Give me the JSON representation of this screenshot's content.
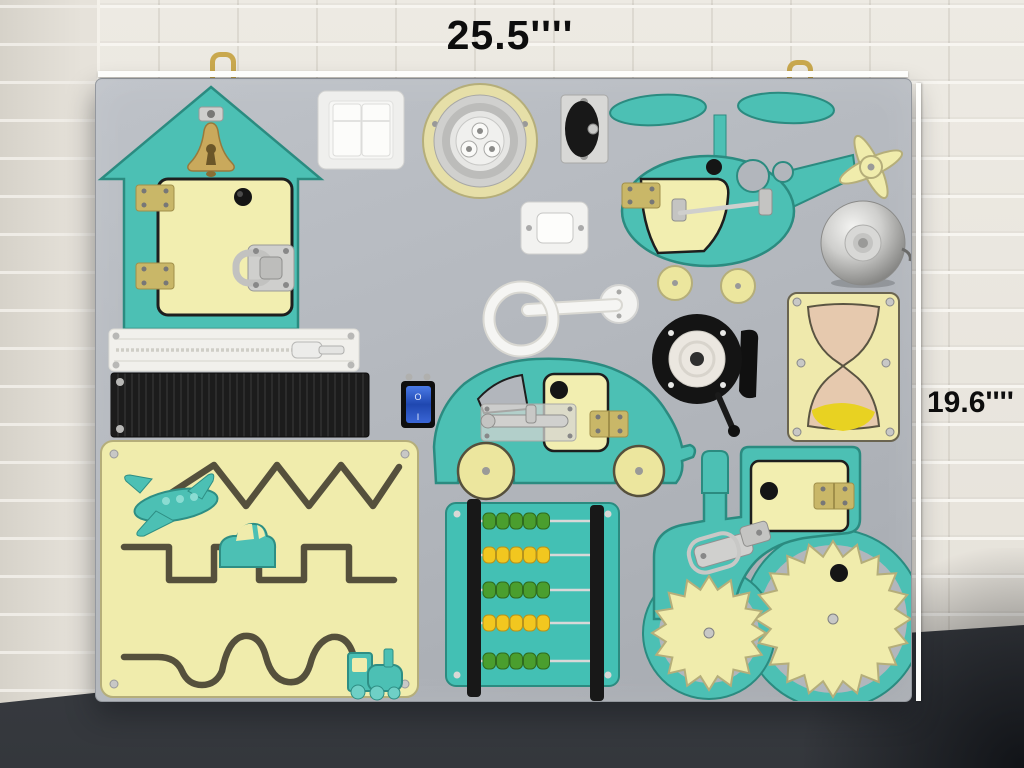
{
  "annotations": {
    "width_label": "25.5''''",
    "height_label": "19.6''''"
  },
  "rocker_switch": {
    "top_mark": "O",
    "bottom_mark": "I"
  },
  "abacus": {
    "rows": [
      {
        "color": "green",
        "count": 5
      },
      {
        "color": "yellow",
        "count": 5
      },
      {
        "color": "green",
        "count": 5
      },
      {
        "color": "yellow",
        "count": 5
      },
      {
        "color": "green",
        "count": 5
      }
    ]
  },
  "palette": {
    "wall_white": "#eae6df",
    "side_wall": "#e0dcd4",
    "table_dark": "#3d4046",
    "board_gray": "#b2b6bc",
    "teal": "#4cc0b4",
    "teal_dark": "#2b8b80",
    "pale_yellow": "#f2eeb0",
    "maze_yellow": "#f0ecac",
    "gold_bell": "#c9a95c",
    "brass_hinge": "#c9b768",
    "silver": "#d0d0ce",
    "black_part": "#161616",
    "white_part": "#f2f2f0",
    "switch_blue": "#2d5ac8",
    "bead_green": "#4a9e2e",
    "bead_yellow": "#f2c71f",
    "sand_yellow": "#e8d222",
    "hourglass_skin": "#e6c9ae",
    "annotation_line": "#fdfdfb",
    "annotation_text": "#0d0d0d",
    "hook_gold": "#c9a84e"
  },
  "components": [
    "house-with-bell-and-latch-door",
    "double-light-switch",
    "push-led-light",
    "caster-wheel",
    "helicopter-with-hook-latch-door",
    "doorbell-button",
    "call-bell",
    "yellow-discs",
    "towel-ring-handle",
    "rope-reel",
    "hourglass",
    "zipper",
    "velcro-strip",
    "blue-rocker-switch",
    "car-with-barrel-bolt-door",
    "maze-board-with-sliders",
    "abacus",
    "tractor-with-gears-and-toggle-latch"
  ]
}
